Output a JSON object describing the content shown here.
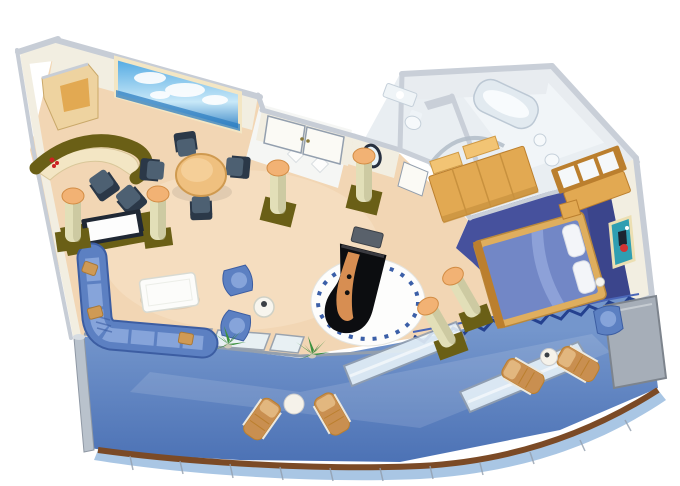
{
  "scene": {
    "description": "Isometric cutaway floor plan of a luxury cruise-ship suite with a curved private balcony",
    "rooms": [
      {
        "name": "living-room",
        "furniture": [
          "corner-cabinet",
          "bar-counter",
          "bar-chairs",
          "wall-mural",
          "dining-table",
          "dining-chairs",
          "tv-cabinet",
          "flat-tv",
          "l-shaped-sofa",
          "throw-pillows",
          "coffee-table",
          "blue-armchairs",
          "side-table",
          "grand-piano",
          "piano-bench",
          "round-rug",
          "decorative-columns",
          "potted-plants"
        ]
      },
      {
        "name": "entry-foyer",
        "furniture": [
          "double-entry-doors",
          "marble-diamond-floor",
          "porthole-window"
        ]
      },
      {
        "name": "bathrooms",
        "furniture": [
          "bathtub",
          "sink-counter",
          "toilet",
          "curved-shower-enclosure",
          "second-sink"
        ]
      },
      {
        "name": "dressing-area",
        "furniture": [
          "wardrobe",
          "shelf-boxes",
          "bathroom-door"
        ]
      },
      {
        "name": "bedroom",
        "furniture": [
          "double-bed",
          "white-pillows",
          "nightstand",
          "floor-lamp",
          "vanity-with-mirror",
          "blue-armchair",
          "framed-wall-picture"
        ]
      },
      {
        "name": "balcony",
        "furniture": [
          "glass-sliding-doors",
          "glass-balustrade",
          "leaning-glass-panels",
          "privacy-screen",
          "sun-loungers",
          "round-tables",
          "teak-trim",
          "hull-railing"
        ]
      }
    ],
    "counts": {
      "decorative_columns": 6,
      "sun_loungers": 4,
      "dining_chairs": 4,
      "bar_chairs": 2,
      "blue_armchairs": 3,
      "entry_doors": 2,
      "plants": 2,
      "round_balcony_tables": 2
    }
  },
  "palette": {
    "white": "#ffffff",
    "floorTan": "#f2d6b4",
    "floorTanLight": "#f9e7cd",
    "marble": "#f5f6f4",
    "bathFloor": "#e9eef2",
    "bathRoom": "#f1f5f8",
    "bedroomFloor": "#46519d",
    "bedroomFloorDark": "#2f3878",
    "wallFace": "#f2eee1",
    "wallCap": "#c7cdd6",
    "wallEdge": "#98a1ae",
    "grayWall": "#c9cfd8",
    "grayWallFace": "#e8ecf0",
    "olive": "#6a5f16",
    "cream": "#f3e6c4",
    "woodLight": "#eed3a0",
    "wood": "#e2a952",
    "woodDark": "#bb7f2e",
    "colBody": "#e2dfb8",
    "colShade": "#b8b58c",
    "colTop": "#f2b274",
    "colTopRim": "#d28c44",
    "navyChair": "#2b3848",
    "navySeat": "#4d6072",
    "tableTan": "#efc07f",
    "tableTanDark": "#cf9a50",
    "sofaBlue": "#5c80c2",
    "sofaLight": "#86a4da",
    "sofaDark": "#3c5da2",
    "pillowTan": "#cf9a55",
    "tvFrame": "#202834",
    "tvScreen": "#fdfdfd",
    "muralSky": "#4fa8e2",
    "muralSkyLight": "#c8e8f8",
    "muralSea": "#2f7fc2",
    "cloudWhite": "#ffffff",
    "deck": "#4a70b4",
    "deckLight": "#7496cc",
    "glass": "#e8f3f9",
    "glassFrame": "#939fae",
    "hullTrim": "#7b4a26",
    "hullBlue": "#a9c6e4",
    "screenGray": "#a6aeb8",
    "piano": "#0c0d10",
    "pianoInner": "#d78e52",
    "bench": "#59616b",
    "rugWhite": "#fdfdfc",
    "rugDotBlue": "#3b5fa8",
    "plantGreen": "#3e9140",
    "plantDark": "#2c6e32",
    "lounger": "#c98f50",
    "loungerLight": "#e2b77f",
    "pictureTeal": "#2f9eb2",
    "pictureRed": "#d23434",
    "flowerRed": "#cc2222",
    "doorWhite": "#fbfaf5",
    "sawtooth": "#24418f",
    "sawtoothLight": "#4a66b8",
    "bedFrame": "#dfae5e",
    "bedSpread": "#7287c6",
    "bedFold": "#94a7dc",
    "pillowWhite": "#f3f5f9"
  }
}
